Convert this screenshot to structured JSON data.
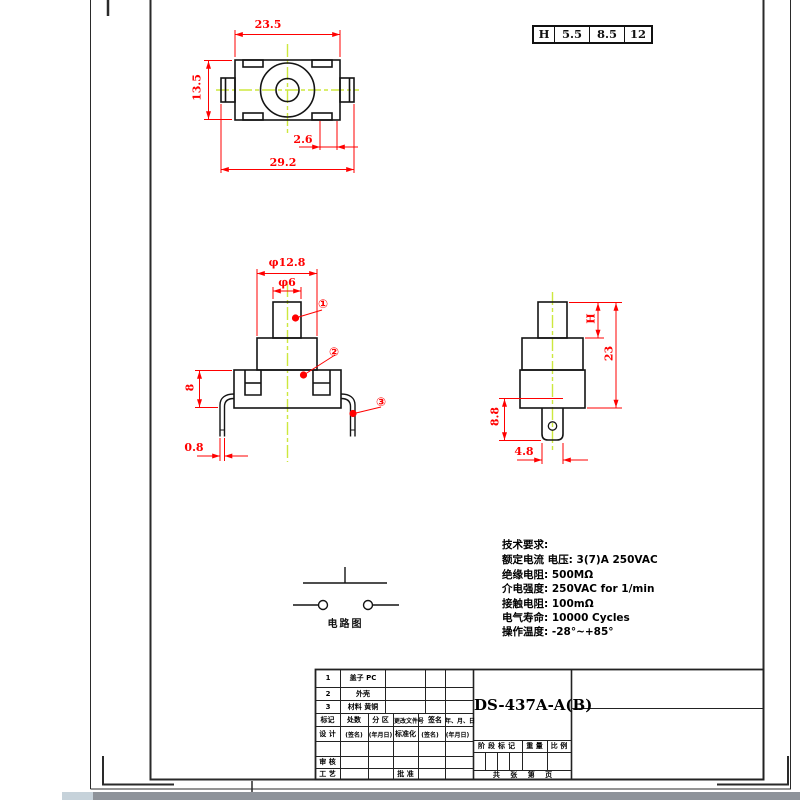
{
  "h_table": {
    "cells": [
      "H",
      "5.5",
      "8.5",
      "12"
    ]
  },
  "top_view": {
    "dim_body_width": "23.5",
    "dim_body_height": "13.5",
    "dim_notch_offset": "2.6",
    "dim_total_width": "29.2"
  },
  "front_view": {
    "dim_cap_dia": "φ12.8",
    "dim_stem_dia": "φ6",
    "dim_base_height": "8",
    "dim_leg_thickness": "0.8",
    "callouts": [
      "①",
      "②",
      "③"
    ]
  },
  "side_view": {
    "dim_cap_height": "H",
    "dim_total_height": "23",
    "dim_terminal_length": "8.8",
    "dim_terminal_width": "4.8"
  },
  "circuit": {
    "label": "电路图"
  },
  "tech_requirements": {
    "title": "技术要求:",
    "lines": [
      "额定电流 电压: 3(7)A 250VAC",
      "绝缘电阻: 500MΩ",
      "介电强度: 250VAC for 1/min",
      "接触电阻: 100mΩ",
      "电气寿命: 10000 Cycles",
      "操作温度: -28°~+85°"
    ]
  },
  "title_block": {
    "part_number": "DS-437A-A(B)",
    "bom": [
      {
        "no": "1",
        "name": "盖子 PC"
      },
      {
        "no": "2",
        "name": "外壳"
      },
      {
        "no": "3",
        "name": "材料 黄铜"
      }
    ],
    "revision_header": [
      "标记",
      "处数",
      "分 区",
      "更改文件号",
      "签名",
      "年、月、日"
    ],
    "sign_row": [
      "设 计",
      "(签名)",
      "(年月日)",
      "标准化",
      "(签名)",
      "(年月日)"
    ],
    "audit_label": "审 核",
    "process_label": "工 艺",
    "approve_label": "批 准",
    "stage_labels": [
      "阶段标记",
      "重 量",
      "比 例"
    ],
    "sheet_footer": "共 张 第 页"
  },
  "colors": {
    "dimension_red": "#ff0000",
    "centerline_yellow": "#cde83e",
    "line_black": "#141414"
  }
}
